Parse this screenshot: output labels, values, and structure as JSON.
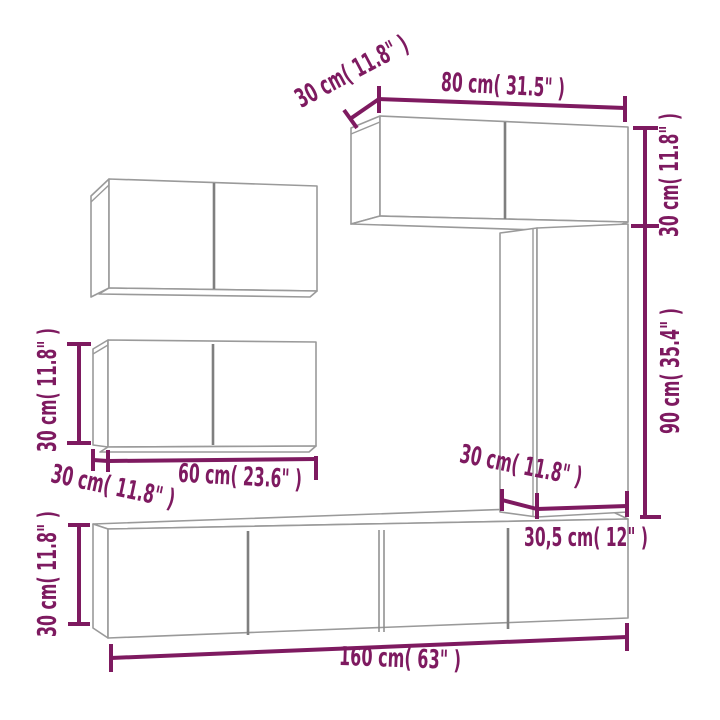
{
  "palette": {
    "dimension_color": "#7E1A60",
    "outline_color": "#9A9A9A",
    "divider_color": "#7F7F7F",
    "background": "#FFFFFF"
  },
  "diagram": {
    "type": "furniture-dimension-line-drawing",
    "labels": {
      "top_depth": "30 cm( 11.8\" )",
      "top_width": "80 cm( 31.5\" )",
      "upper_right_height": "30 cm( 11.8\" )",
      "right_height": "90 cm( 35.4\" )",
      "tall_depth": "30 cm( 11.8\" )",
      "tall_width": "30,5 cm( 12\" )",
      "side_height": "30 cm( 11.8\" )",
      "side_depth": "30 cm( 11.8\" )",
      "side_width": "60 cm( 23.6\" )",
      "stand_height": "30 cm( 11.8\" )",
      "stand_width": "160 cm( 63\" )"
    }
  }
}
